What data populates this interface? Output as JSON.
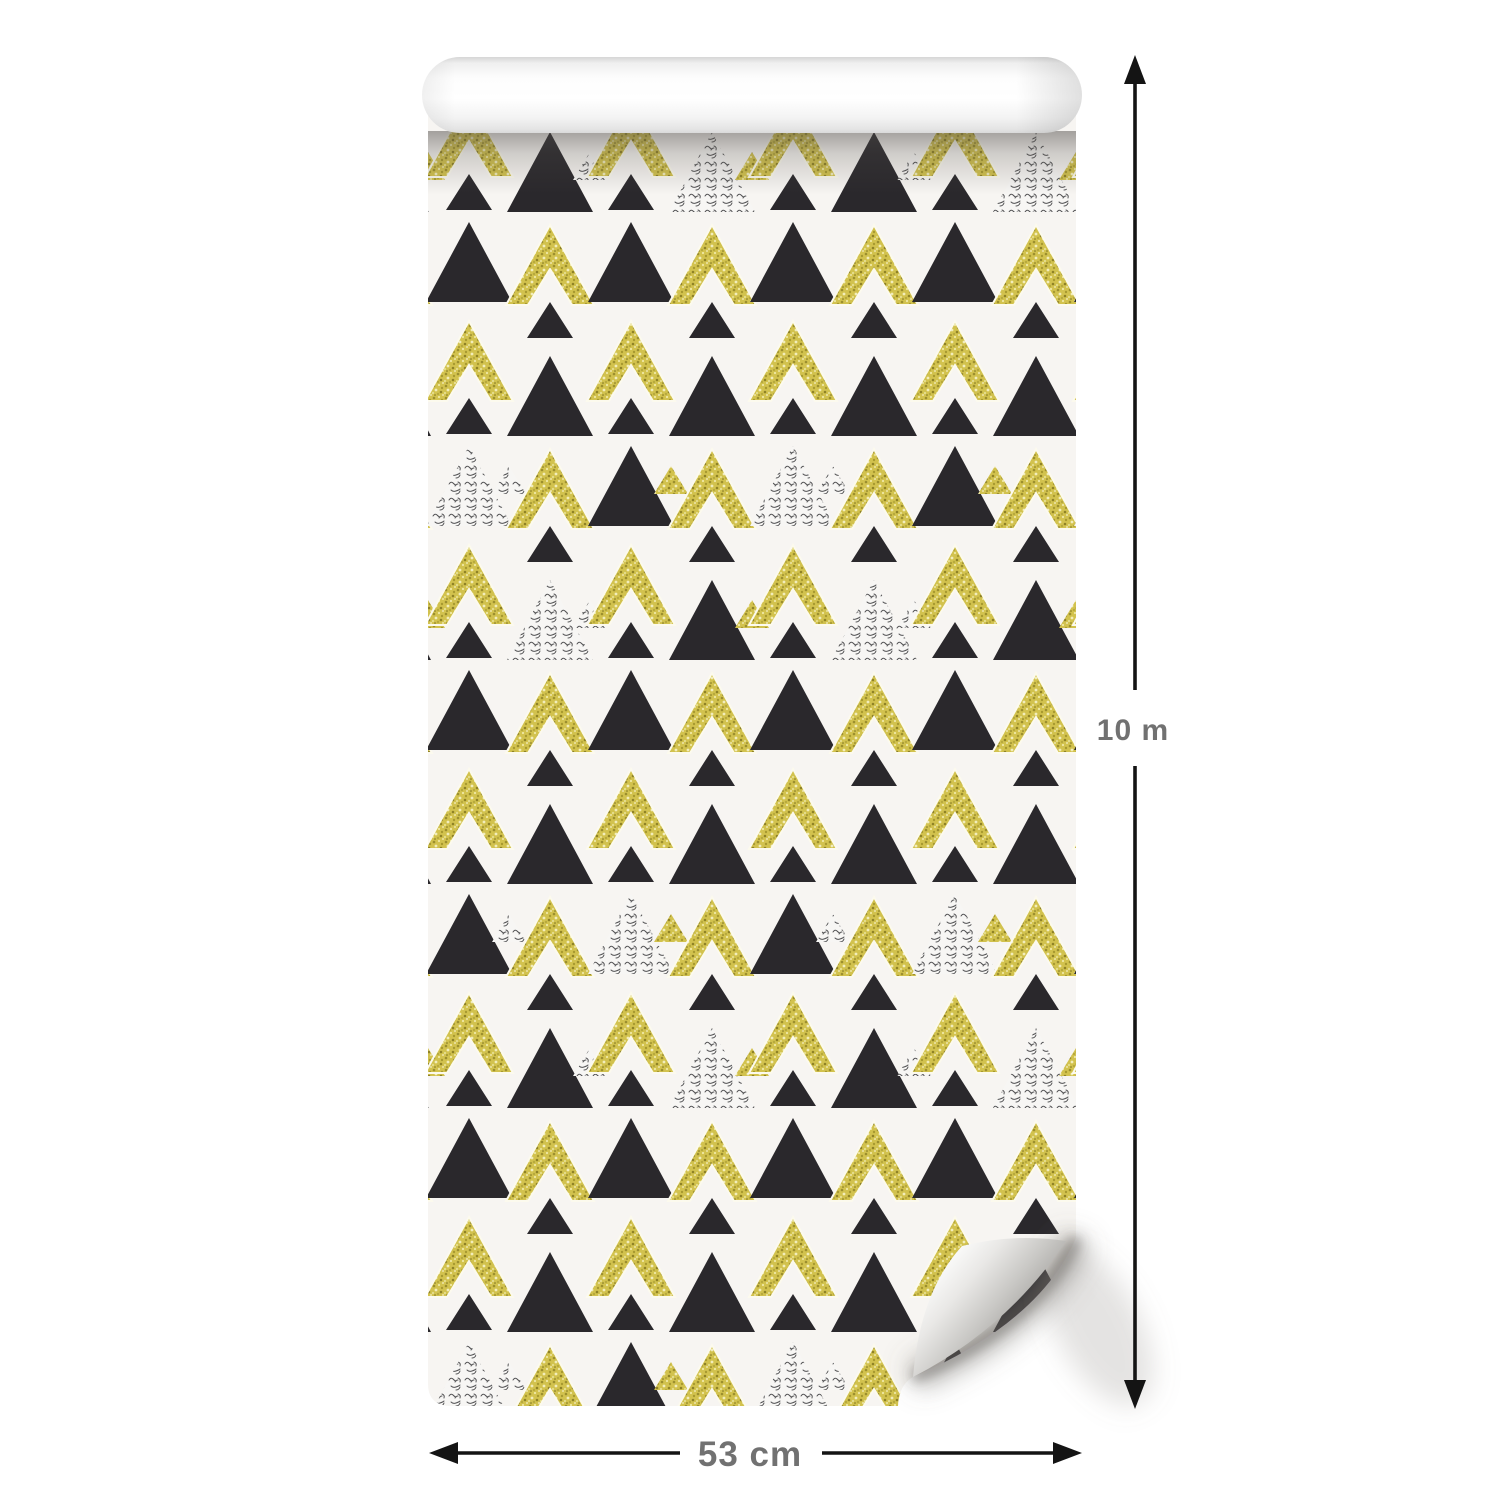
{
  "product_image": {
    "subject": "wallpaper-roll-mockup",
    "background": "#ffffff"
  },
  "annotations": {
    "height_label": "10 m",
    "width_label": "53 cm",
    "label_color": "#717171",
    "arrow_color": "#141414",
    "height_arrow_icon": "vertical-double-arrow",
    "width_arrow_icon": "horizontal-double-arrow"
  },
  "wallpaper": {
    "paper_color": "#f7f5f2",
    "motifs": [
      "gold-glitter-chevron",
      "black-triangle",
      "silver-scribble-triangle",
      "small-black-triangle",
      "tiny-gold-triangle",
      "tiny-silver-triangle"
    ],
    "colors": {
      "black": "#2a282c",
      "gold_base": "#d2c24e",
      "gold_dark": "#9c8f2e",
      "gold_light": "#efe8a4",
      "silver_base": "#f7f6f4",
      "silver_mark": "#333336",
      "chevron_halo": "#fcfaee"
    }
  }
}
